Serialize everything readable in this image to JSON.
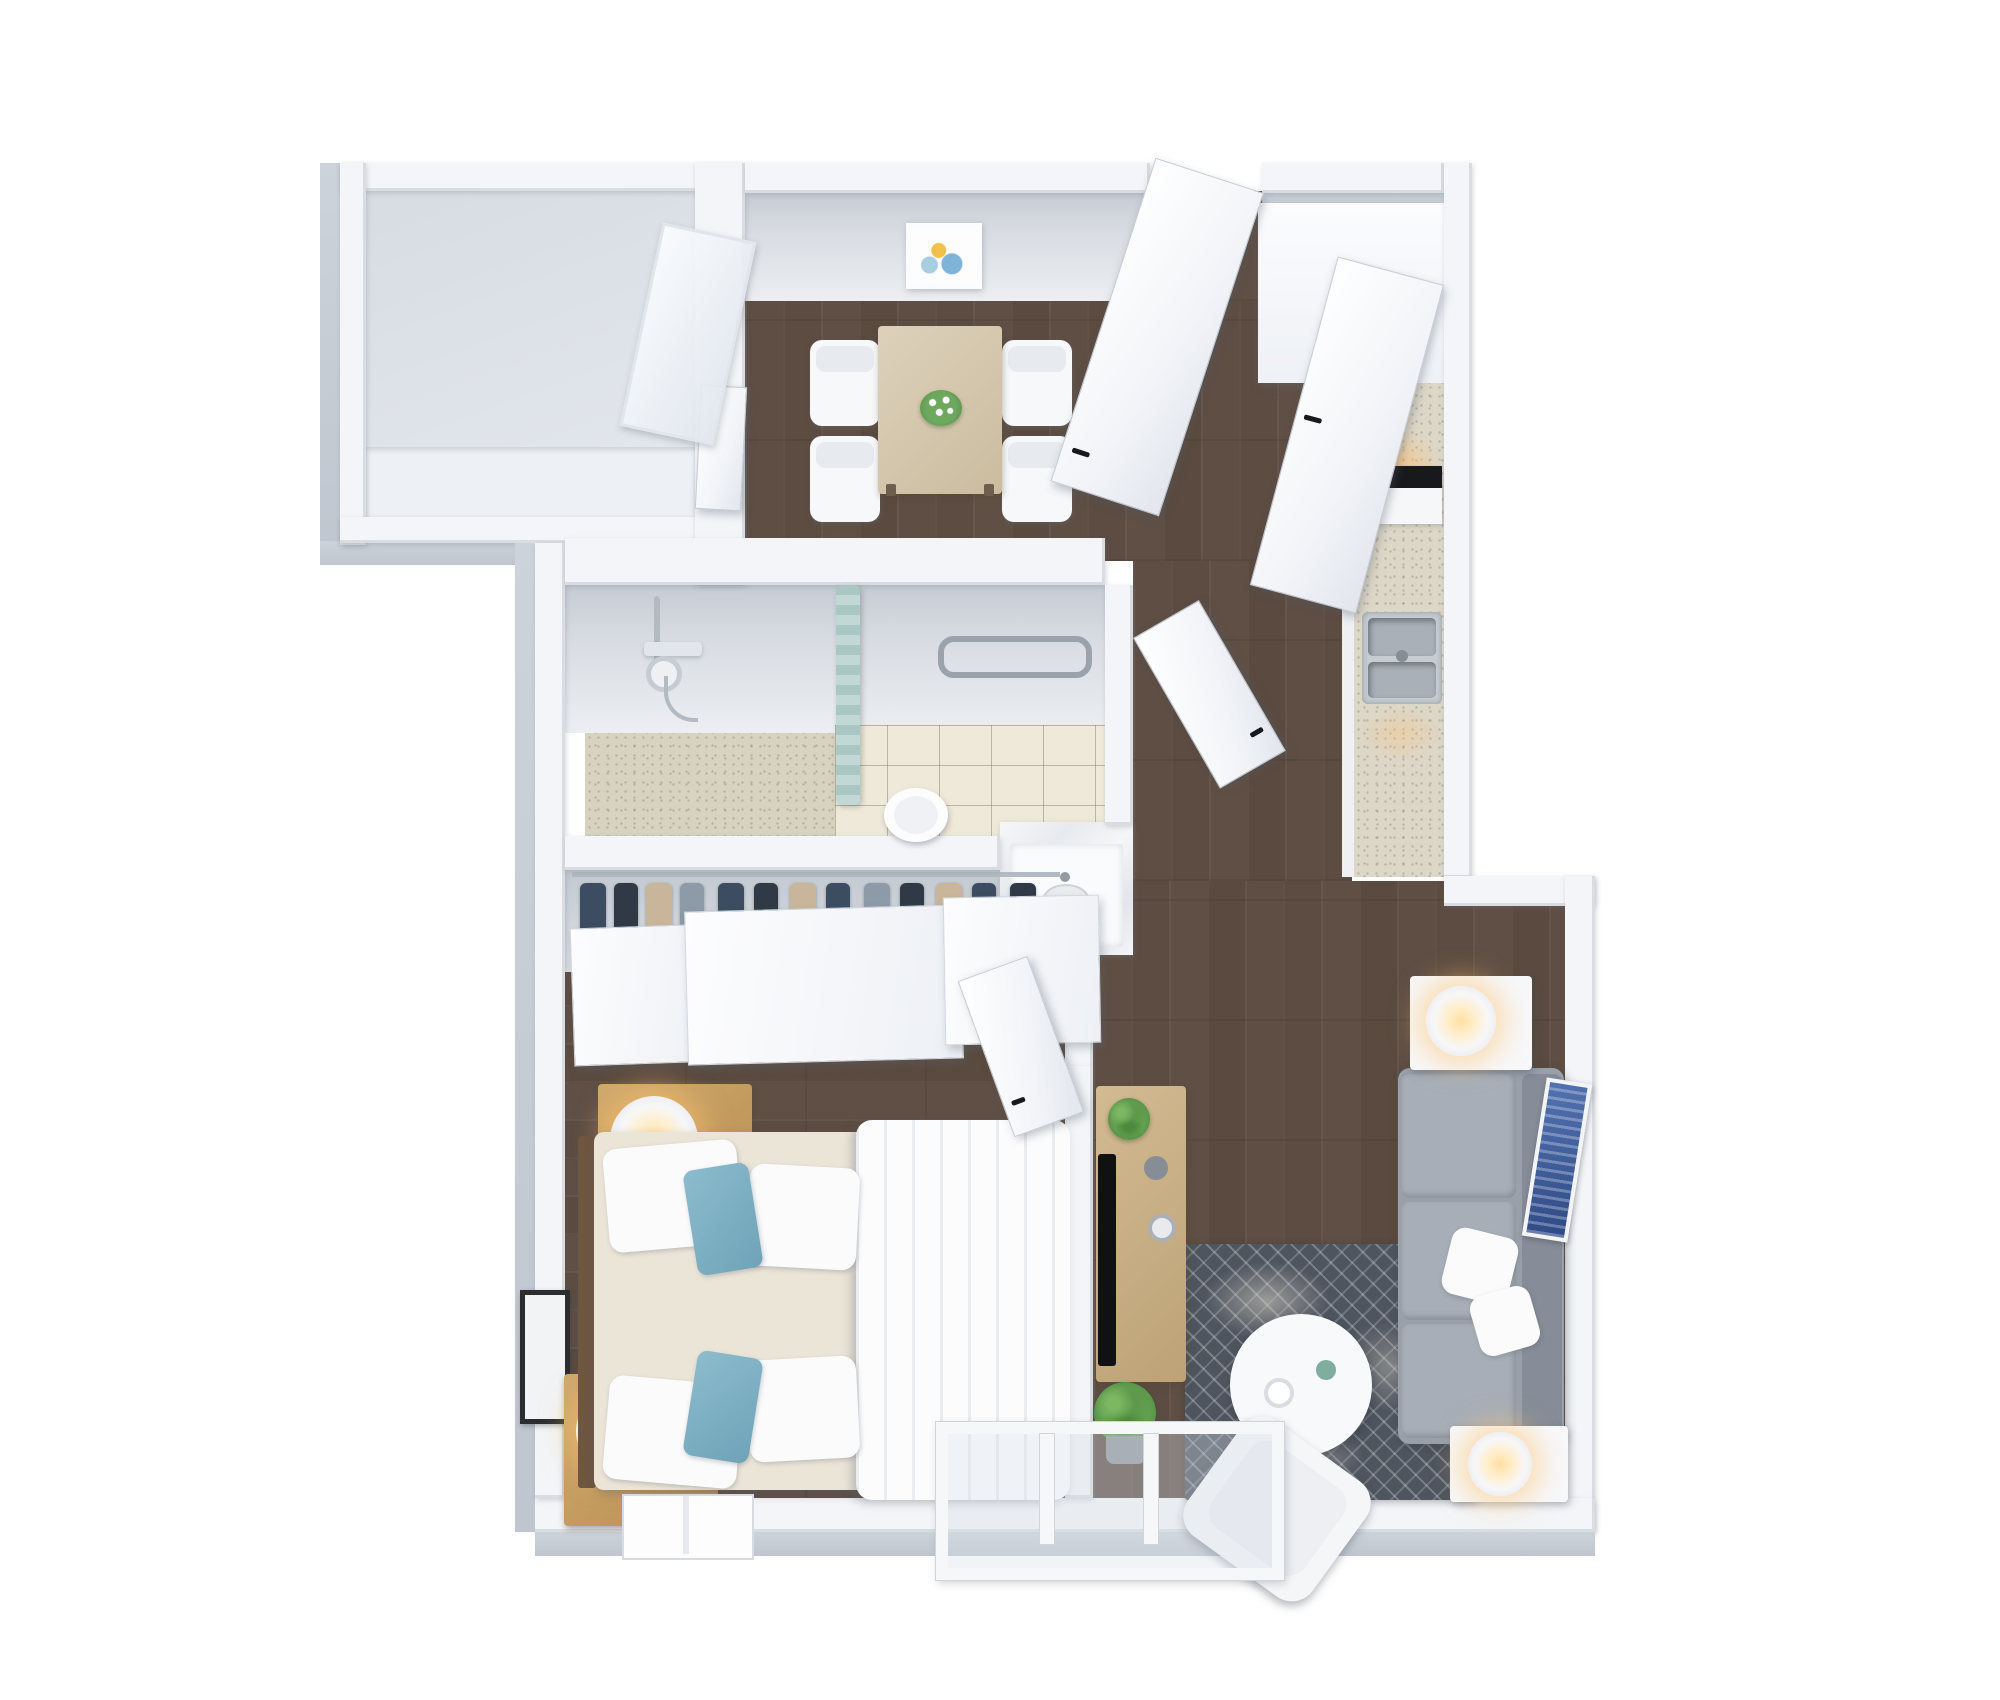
{
  "scene": {
    "type": "3d-floor-plan-render",
    "description": "Isometric 3D floor plan render of a one-bedroom apartment with dark wood floors, white walls, balcony, dining area, kitchen, bathroom, walk-in closet, bedroom and living room",
    "background": "#ffffff"
  },
  "palette": {
    "floor_wood": "#5d4d43",
    "wall_white": "#f3f5f8",
    "wall_shadow": "#c6ccd4",
    "exterior_wall": "#c9cfd7",
    "tile": "#efe9d9",
    "counter_speckle": "#ddd7c8",
    "shower_curtain": "#b7d0cd",
    "sofa_gray": "#99a0aa",
    "rug_navy": "#4e555f",
    "accent_pillow_blue": "#7fb2c6",
    "wood_furniture": "#c29b62",
    "table_wood": "#d5c9b2",
    "lamp_glow": "#ffc87e",
    "art_blue": "#3f5fa0",
    "tv_black": "#101214",
    "plant_green": "#5f9a4c"
  },
  "structure": {
    "wall": "Wall",
    "exterior_wall": "Exterior wall face",
    "parapet": "Balcony parapet",
    "wall_face": "Interior wall face",
    "threshold": "Entry threshold"
  },
  "rooms": {
    "balcony": {
      "label": "Balcony"
    },
    "dining_area": {
      "label": "Dining area",
      "items": [
        "dining table",
        "4 white chairs",
        "flower centerpiece",
        "framed wall picture"
      ]
    },
    "kitchen": {
      "label": "Kitchen",
      "items": [
        "tall cabinet",
        "speckled counter",
        "oven",
        "double-bowl sink",
        "open cabinet door"
      ]
    },
    "hallway": {
      "label": "Hallway",
      "items": [
        "open entry door"
      ]
    },
    "bathroom": {
      "label": "Bathroom",
      "items": [
        "walk-in shower",
        "teal shower curtain",
        "towel bar",
        "toilet",
        "marble vanity"
      ]
    },
    "closet": {
      "label": "Wardrobe closet",
      "items": [
        "hanging clothes",
        "3 sliding doors"
      ]
    },
    "bedroom": {
      "label": "Bedroom",
      "items": [
        "double bed with white duvet",
        "blue accent pillows",
        "2 wooden nightstands",
        "2 lit table lamps",
        "framed art",
        "window"
      ]
    },
    "living_room": {
      "label": "Living room",
      "items": [
        "gray corner sofa",
        "white throw pillows",
        "round coffee table",
        "white armchair",
        "geometric rug",
        "TV console",
        "TV",
        "plants",
        "blue wall art",
        "bay window",
        "2 side tables with lit lamps"
      ]
    }
  },
  "furniture": {
    "entry_door": "Entry door (open)",
    "cabinet_door": "Kitchen cabinet door (open)",
    "bathroom_door": "Bathroom door (open)",
    "bedroom_door": "Bedroom door (open)",
    "interior_door": "Interior door leaf",
    "balcony_door": "Balcony glass door",
    "dining_table": "Dining table",
    "dining_chair": "Dining chair",
    "centerpiece": "Flower centerpiece",
    "dining_picture": "Framed picture",
    "tall_cabinet": "Kitchen tall cabinet",
    "counter": "Kitchen counter",
    "oven": "Oven",
    "sink": "Kitchen sink",
    "shower": "Walk-in shower",
    "shower_curtain": "Shower curtain",
    "towel_bar": "Towel bar",
    "toilet": "Toilet",
    "vanity": "Marble vanity with sink",
    "clothes_rail": "Hanging clothes",
    "sliding_door": "Sliding closet door",
    "bed": "Double bed",
    "duvet": "White duvet",
    "headboard": "Headboard",
    "pillow": "Pillow",
    "accent_pillow": "Blue accent pillow",
    "nightstand": "Wooden nightstand",
    "table_lamp": "Table lamp (lit)",
    "wall_frame": "Framed wall art",
    "bedroom_window": "Bedroom window",
    "sofa": "Gray corner sofa",
    "throw_pillow": "White throw pillow",
    "coffee_table": "Round coffee table",
    "armchair": "White armchair",
    "rug": "Geometric area rug",
    "side_table": "Side table",
    "tv_console": "Wooden TV console",
    "tv": "Television",
    "plant": "Green plant",
    "wall_art": "Blue wall art",
    "bay_window": "Bay window"
  }
}
